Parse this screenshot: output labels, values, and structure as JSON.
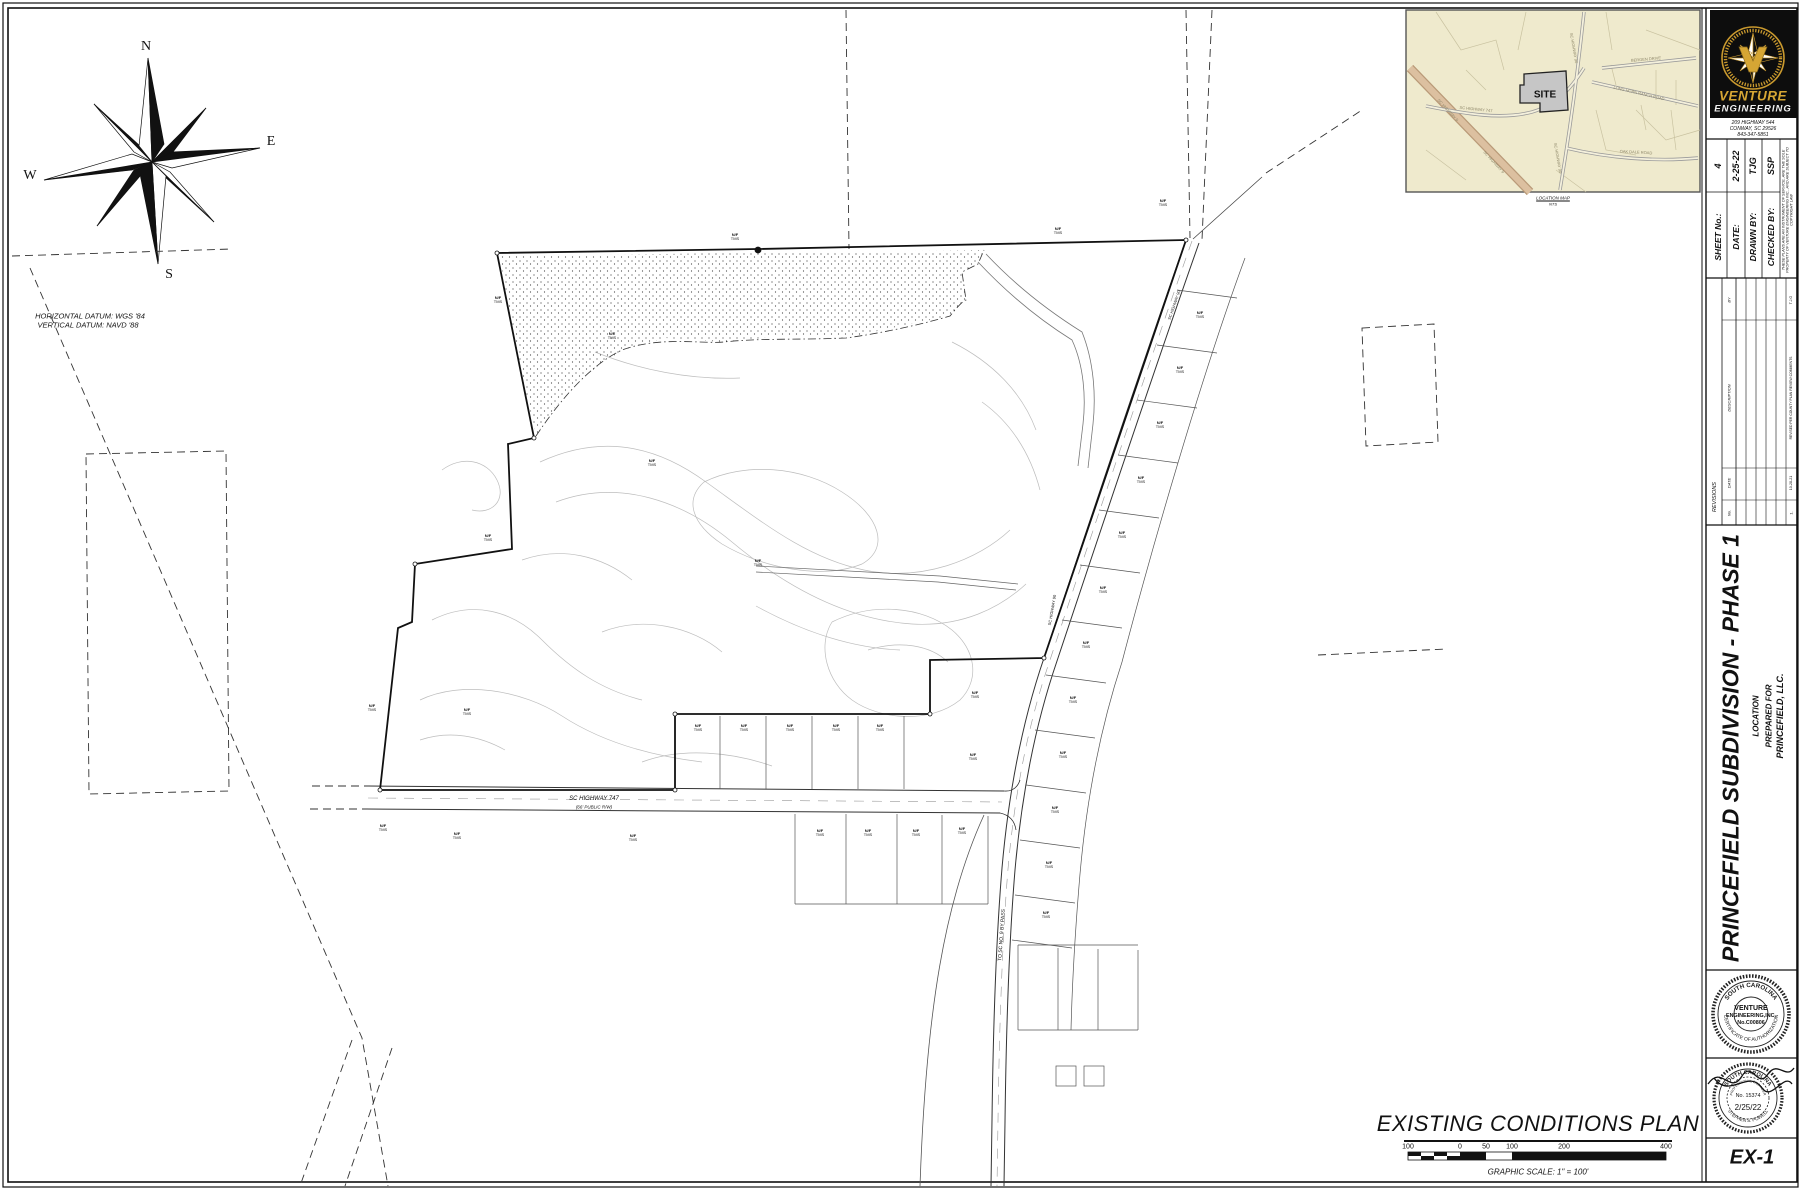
{
  "compass": {
    "north": "N",
    "east": "E",
    "south": "S",
    "west": "W"
  },
  "datum": {
    "horizontal": "HORIZONTAL DATUM:  WGS '84",
    "vertical": "VERTICAL DATUM:  NAVD '88"
  },
  "location_map": {
    "site_label": "SITE",
    "caption": "LOCATION MAP",
    "scale_note": "NTS",
    "roads": [
      {
        "text": "SC HIGHWAY 747",
        "x": 70,
        "y": 99,
        "rot": 6
      },
      {
        "text": "SC HIGHWAY 90",
        "x": 168,
        "y": 38,
        "rot": 80
      },
      {
        "text": "SC HIGHWAY 90",
        "x": 152,
        "y": 148,
        "rot": 80
      },
      {
        "text": "SC HIGHWAY 9",
        "x": 42,
        "y": 100,
        "rot": 47
      },
      {
        "text": "SC HIGHWAY 9",
        "x": 88,
        "y": 152,
        "rot": 47
      },
      {
        "text": "BERGEN DRIVE",
        "x": 240,
        "y": 49,
        "rot": -5
      },
      {
        "text": "LONG HORN RANCH ROAD",
        "x": 233,
        "y": 83,
        "rot": 13
      },
      {
        "text": "OAK DALE ROAD",
        "x": 230,
        "y": 142,
        "rot": 3
      }
    ]
  },
  "plan": {
    "title": "EXISTING CONDITIONS PLAN",
    "scale_caption": "GRAPHIC SCALE: 1\" = 100'",
    "scale_ticks": [
      "100",
      "0",
      "50",
      "100",
      "200",
      "400"
    ],
    "highway_name": "SC HIGHWAY 747",
    "highway_rw": "(66' PUBLIC R/W)",
    "to_road": "TO SC NO. 9 BY PASS",
    "road_name_side": "SC HIGHWAY 90",
    "parcel_label_line1": "N/F",
    "parcel_label_line2": "TMS"
  },
  "title_block": {
    "logo": {
      "name": "VENTURE",
      "name2": "ENGINEERING",
      "address": "209 HIGHWAY 544",
      "city": "CONWAY, SC 29526",
      "phone": "843-347-5851"
    },
    "info": {
      "sheet_no_label": "SHEET No.:",
      "sheet_no": "4",
      "date_label": "DATE:",
      "date": "2-25-22",
      "drawn_label": "DRAWN BY:",
      "drawn": "TJG",
      "checked_label": "CHECKED BY:",
      "checked": "SSP",
      "disclaimer": "THESE PLANS ARE AN INSTRUMENT OF SERVICE, ARE THE SOLE PROPERTY OF VENTURE ENGINEERING INC., AND ARE SUBJECT TO COPYRIGHT LAW"
    },
    "revisions": {
      "title": "REVISIONS",
      "no_label": "No.",
      "date_label": "DATE",
      "by_label": "BY",
      "description_label": "DESCRIPTION",
      "row1": {
        "no": "1.",
        "date": "10-28-21",
        "description": "REVISED PER COUNTY PLAN REVIEW COMMENTS",
        "by": "T.J.G"
      }
    },
    "project": {
      "title": "PRINCEFIELD SUBDIVISION - PHASE 1",
      "location_label": "LOCATION",
      "prepared_for": "PREPARED FOR",
      "client": "PRINCEFIELD, LLC."
    },
    "seal_firm": {
      "arc_top": "SOUTH CAROLINA",
      "line1": "VENTURE",
      "line2": "ENGINEERING,INC.",
      "line3": "No.C00806",
      "arc_bottom": "CERTIFICATE OF AUTHORIZATION"
    },
    "seal_pe": {
      "arc_top": "SOUTH CAROLINA",
      "arc_top2": "PROFESSIONAL ENGINEER",
      "number": "No. 15374",
      "date": "2/25/22",
      "arc_bottom": "STEPHEN S. POWELL"
    },
    "sheet_id": "EX-1"
  }
}
